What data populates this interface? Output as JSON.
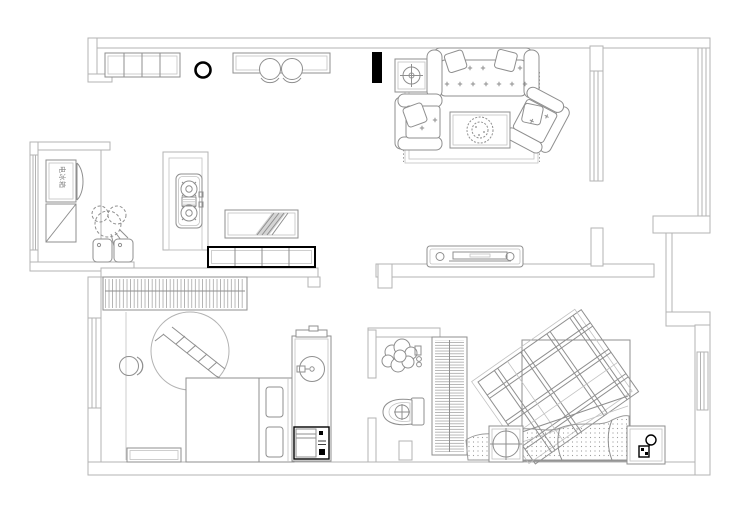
{
  "plan": {
    "labels": {
      "fridge_cabinet_text": "电冰箱"
    },
    "colors": {
      "background": "#ffffff",
      "wall_line": "#b3b3b3",
      "furniture_line": "#8f8f8f",
      "accent_black": "#000000"
    },
    "furniture_icons": [
      "wall-cabinet",
      "pendant-lamp-icon",
      "bar-counter",
      "bar-stool",
      "fridge-cabinet",
      "appliance-cabinet",
      "plant-icon",
      "double-sink",
      "gas-stove-icon",
      "art-panel",
      "shoe-cabinet",
      "side-table-lamp-icon",
      "sofa",
      "armchair",
      "coffee-table",
      "plant-pot-icon",
      "rug",
      "tv-cabinet",
      "wardrobe",
      "round-canopy",
      "ladder-icon",
      "stool",
      "single-bed",
      "bench",
      "washbasin-column",
      "washing-machine-icon",
      "shower-icon",
      "toilet-icon",
      "striped-wardrobe",
      "double-bed",
      "tartan-blanket",
      "pillows",
      "nightstand",
      "desk-lamp-icon",
      "window",
      "column"
    ]
  }
}
